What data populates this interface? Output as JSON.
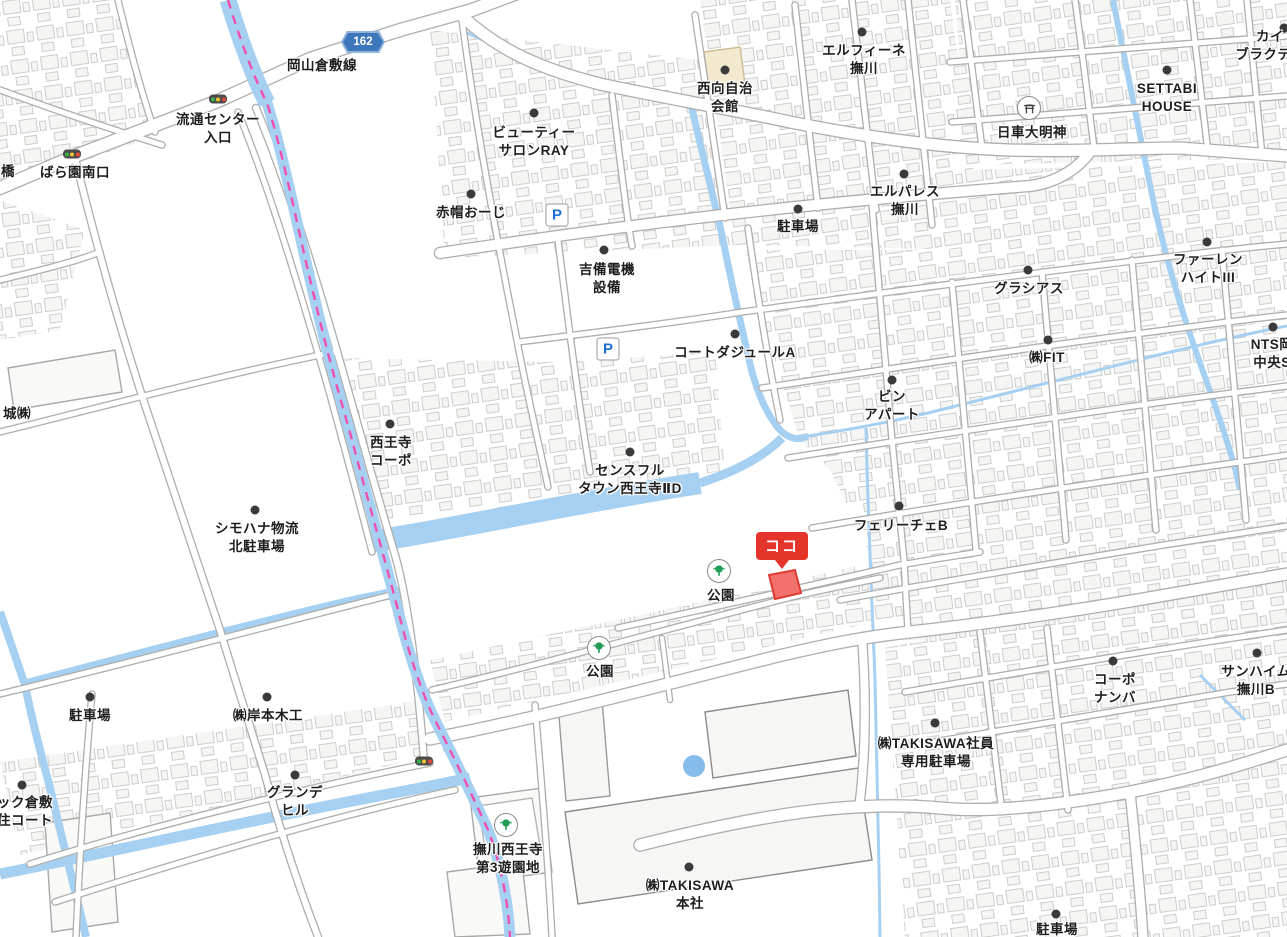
{
  "map": {
    "marker": {
      "text": "ココ",
      "x": 782,
      "y": 560
    },
    "route_badge": {
      "number": "162",
      "x": 363,
      "y": 42
    },
    "colors": {
      "water": "#a6d0f2",
      "boundary_pink": "#f04fb0",
      "marker_red": "#e5352b",
      "highlight_building_fill": "#f3716c",
      "highlight_building_stroke": "#e03b33",
      "parking_blue": "#1c6fd1",
      "park_green": "#1f9d55",
      "route_blue": "#3c76bb"
    },
    "labels": [
      {
        "lines": [
          "橋"
        ],
        "x": 8,
        "y": 172
      },
      {
        "lines": [
          "ばら園南口"
        ],
        "x": 75,
        "y": 173
      },
      {
        "lines": [
          "流通センター",
          "入口"
        ],
        "x": 218,
        "y": 129
      },
      {
        "lines": [
          "岡山倉敷線"
        ],
        "x": 322,
        "y": 66
      },
      {
        "lines": [
          "ビューティー",
          "サロンRAY"
        ],
        "x": 534,
        "y": 142
      },
      {
        "lines": [
          "赤帽おーじ"
        ],
        "x": 471,
        "y": 213
      },
      {
        "lines": [
          "吉備電機",
          "設備"
        ],
        "x": 607,
        "y": 279
      },
      {
        "lines": [
          "西向自治",
          "会館"
        ],
        "x": 725,
        "y": 98
      },
      {
        "lines": [
          "エルフィーネ",
          "撫川"
        ],
        "x": 864,
        "y": 60
      },
      {
        "lines": [
          "エルパレス",
          "撫川"
        ],
        "x": 905,
        "y": 201
      },
      {
        "lines": [
          "駐車場"
        ],
        "x": 798,
        "y": 227
      },
      {
        "lines": [
          "日車大明神"
        ],
        "x": 1032,
        "y": 133
      },
      {
        "lines": [
          "SETTABI",
          "HOUSE"
        ],
        "x": 1167,
        "y": 98
      },
      {
        "lines": [
          "カイ",
          "ブラクティ"
        ],
        "x": 1270,
        "y": 46
      },
      {
        "lines": [
          "グラシアス"
        ],
        "x": 1029,
        "y": 289
      },
      {
        "lines": [
          "ファーレン",
          "ハイトIII"
        ],
        "x": 1208,
        "y": 269
      },
      {
        "lines": [
          "㈱FIT"
        ],
        "x": 1047,
        "y": 358
      },
      {
        "lines": [
          "NTS岡",
          "中央S"
        ],
        "x": 1272,
        "y": 354
      },
      {
        "lines": [
          "コートダジュールA"
        ],
        "x": 735,
        "y": 353
      },
      {
        "lines": [
          "ビン",
          "アパート"
        ],
        "x": 892,
        "y": 406
      },
      {
        "lines": [
          "西王寺",
          "コーポ"
        ],
        "x": 391,
        "y": 452
      },
      {
        "lines": [
          "センスフル",
          "タウン西王寺ⅡD"
        ],
        "x": 630,
        "y": 480
      },
      {
        "lines": [
          "シモハナ物流",
          "北駐車場"
        ],
        "x": 257,
        "y": 538
      },
      {
        "lines": [
          "フェリーチェB"
        ],
        "x": 901,
        "y": 526
      },
      {
        "lines": [
          "公園"
        ],
        "x": 721,
        "y": 596
      },
      {
        "lines": [
          "公園"
        ],
        "x": 600,
        "y": 672
      },
      {
        "lines": [
          "駐車場"
        ],
        "x": 90,
        "y": 716
      },
      {
        "lines": [
          "㈱岸本木工"
        ],
        "x": 268,
        "y": 716
      },
      {
        "lines": [
          "グランデ",
          "ヒル"
        ],
        "x": 295,
        "y": 802
      },
      {
        "lines": [
          "ック倉敷",
          "住コート"
        ],
        "x": 25,
        "y": 812
      },
      {
        "lines": [
          "城㈱"
        ],
        "x": 17,
        "y": 414
      },
      {
        "lines": [
          "撫川西王寺",
          "第3遊園地"
        ],
        "x": 508,
        "y": 859
      },
      {
        "lines": [
          "㈱TAKISAWA",
          "本社"
        ],
        "x": 690,
        "y": 895
      },
      {
        "lines": [
          "㈱TAKISAWA社員",
          "専用駐車場"
        ],
        "x": 936,
        "y": 753
      },
      {
        "lines": [
          "コーポ",
          "ナンバ"
        ],
        "x": 1115,
        "y": 689
      },
      {
        "lines": [
          "サンハイム",
          "撫川B"
        ],
        "x": 1256,
        "y": 681
      },
      {
        "lines": [
          "駐車場"
        ],
        "x": 1057,
        "y": 930
      }
    ],
    "pois": [
      {
        "x": 534,
        "y": 113
      },
      {
        "x": 471,
        "y": 194
      },
      {
        "x": 604,
        "y": 250
      },
      {
        "x": 725,
        "y": 70
      },
      {
        "x": 862,
        "y": 32
      },
      {
        "x": 904,
        "y": 174
      },
      {
        "x": 798,
        "y": 209
      },
      {
        "x": 1167,
        "y": 70
      },
      {
        "x": 1028,
        "y": 270
      },
      {
        "x": 1207,
        "y": 242
      },
      {
        "x": 1048,
        "y": 340
      },
      {
        "x": 1273,
        "y": 327
      },
      {
        "x": 892,
        "y": 380
      },
      {
        "x": 390,
        "y": 424
      },
      {
        "x": 630,
        "y": 452
      },
      {
        "x": 255,
        "y": 510
      },
      {
        "x": 899,
        "y": 506
      },
      {
        "x": 735,
        "y": 334
      },
      {
        "x": 90,
        "y": 697
      },
      {
        "x": 267,
        "y": 697
      },
      {
        "x": 295,
        "y": 775
      },
      {
        "x": 22,
        "y": 785
      },
      {
        "x": 689,
        "y": 867
      },
      {
        "x": 935,
        "y": 723
      },
      {
        "x": 1113,
        "y": 661
      },
      {
        "x": 1257,
        "y": 653
      },
      {
        "x": 1056,
        "y": 914
      },
      {
        "x": 1284,
        "y": 28
      }
    ],
    "traffic_lights": [
      {
        "x": 218,
        "y": 99
      },
      {
        "x": 72,
        "y": 154
      },
      {
        "x": 424,
        "y": 761
      }
    ],
    "parkings": [
      {
        "label": "P",
        "x": 557,
        "y": 215
      },
      {
        "label": "P",
        "x": 608,
        "y": 349
      }
    ],
    "parks": [
      {
        "x": 719,
        "y": 571
      },
      {
        "x": 599,
        "y": 648
      },
      {
        "x": 506,
        "y": 825
      }
    ],
    "shrines": [
      {
        "x": 1029,
        "y": 108
      }
    ],
    "ponds": [
      {
        "x": 694,
        "y": 766,
        "r": 11
      }
    ]
  }
}
